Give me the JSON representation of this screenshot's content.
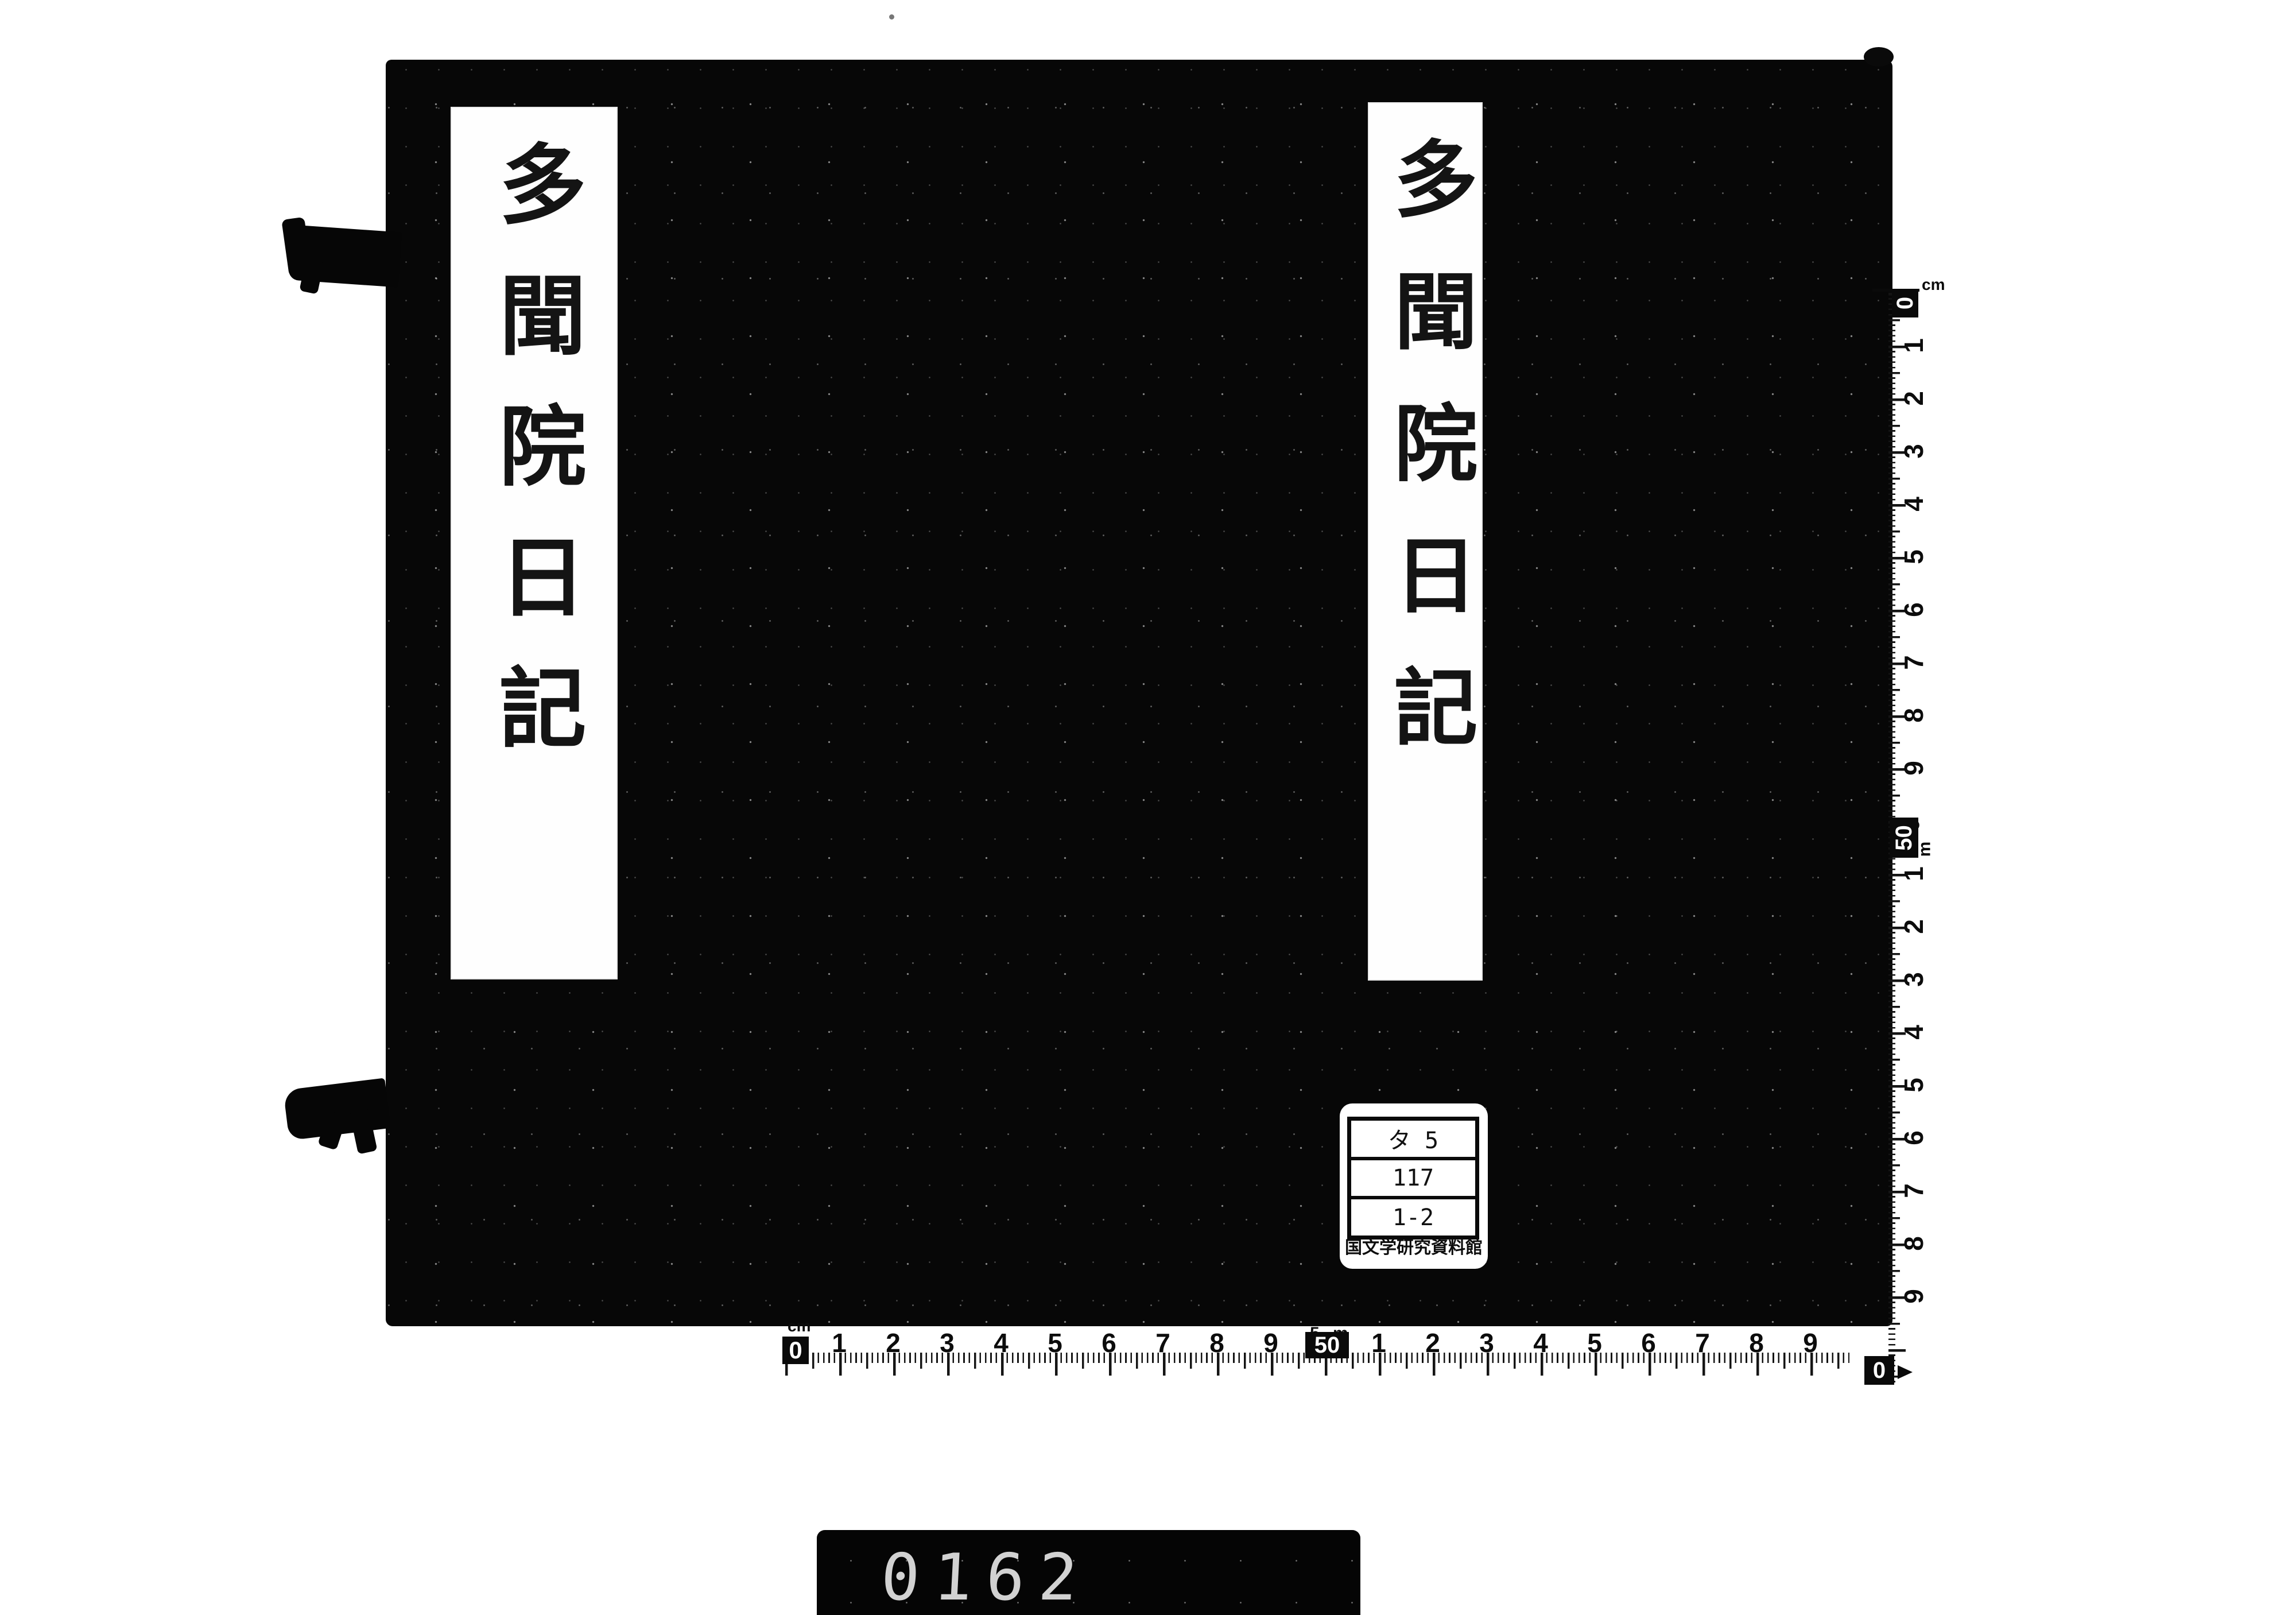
{
  "book": {
    "cover_color": "#070707",
    "title_slips": [
      {
        "position": "left",
        "text": "多聞院日記"
      },
      {
        "position": "right",
        "text": "多聞院日記"
      }
    ]
  },
  "label": {
    "rows": [
      "タ 5",
      "117",
      "1-2"
    ],
    "institution": "国文学研究資料館"
  },
  "rulers": {
    "unit_label": "cm",
    "zero_label": "0",
    "fifty_label": "50",
    "fifty_prefix": "5",
    "meter_label": "m",
    "bottom_first": [
      "1",
      "2",
      "3",
      "4",
      "5",
      "6",
      "7",
      "8",
      "9"
    ],
    "bottom_second": [
      "1",
      "2",
      "3",
      "4",
      "5",
      "6",
      "7",
      "8",
      "9"
    ],
    "right_first": [
      "1",
      "2",
      "3",
      "4",
      "5",
      "6",
      "7",
      "8",
      "9"
    ],
    "right_second": [
      "1",
      "2",
      "3",
      "4",
      "5",
      "6",
      "7",
      "8",
      "9"
    ]
  },
  "counter": {
    "digits": "0162"
  }
}
